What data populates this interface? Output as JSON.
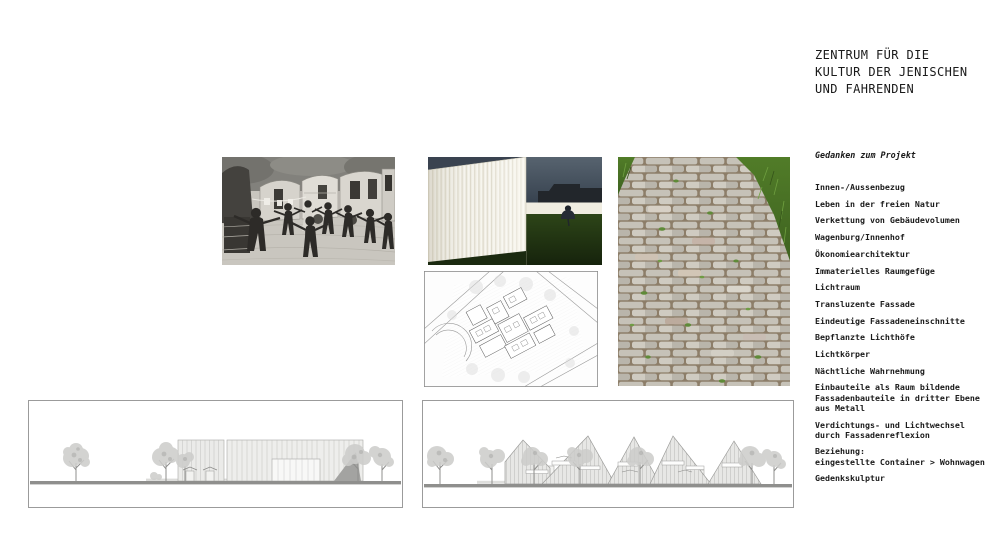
{
  "document": {
    "title": "ZENTRUM FÜR DIE\nKULTUR DER JENISCHEN\nUND FAHRENDEN"
  },
  "thoughts": {
    "heading": "Gedanken zum Projekt",
    "items": [
      "Innen-/Aussenbezug",
      "Leben in der freien Natur",
      "Verkettung von Gebäudevolumen",
      "Wagenburg/Innenhof",
      "Ökonomiearchitektur",
      "Immaterielles Raumgefüge",
      "Lichtraum",
      "Transluzente Fassade",
      "Eindeutige Fassadeneinschnitte",
      "Bepflanzte Lichthöfe",
      "Lichtkörper",
      "Nächtliche Wahrnehmung",
      "Einbauteile als Raum bildende\nFassadenbauteile in dritter Ebene\naus Metall",
      "Verdichtungs- und Lichtwechsel\ndurch Fassadenreflexion",
      "Beziehung:\neingestellte Container > Wohnwagen",
      "Gedenkskulptur"
    ]
  },
  "figures": {
    "historic_photo": "historic-bw-photo-circle-dance-at-caravans",
    "facade_photo": "translucent-white-facade-at-dusk-photo",
    "cobblestone_photo": "cobblestone-path-with-grass-photo",
    "site_plan": "site-plan-line-drawing",
    "elevation_left": "elevation-drawing-flat-roofed-building",
    "elevation_right": "elevation-drawing-gabled-buildings"
  },
  "colors": {
    "text": "#1a1a1a",
    "grass_green": "#4c7226",
    "dusk_sky": "#3b4754",
    "drawing_line": "#9b9b9b",
    "ground_bar": "#8f8f8d"
  }
}
